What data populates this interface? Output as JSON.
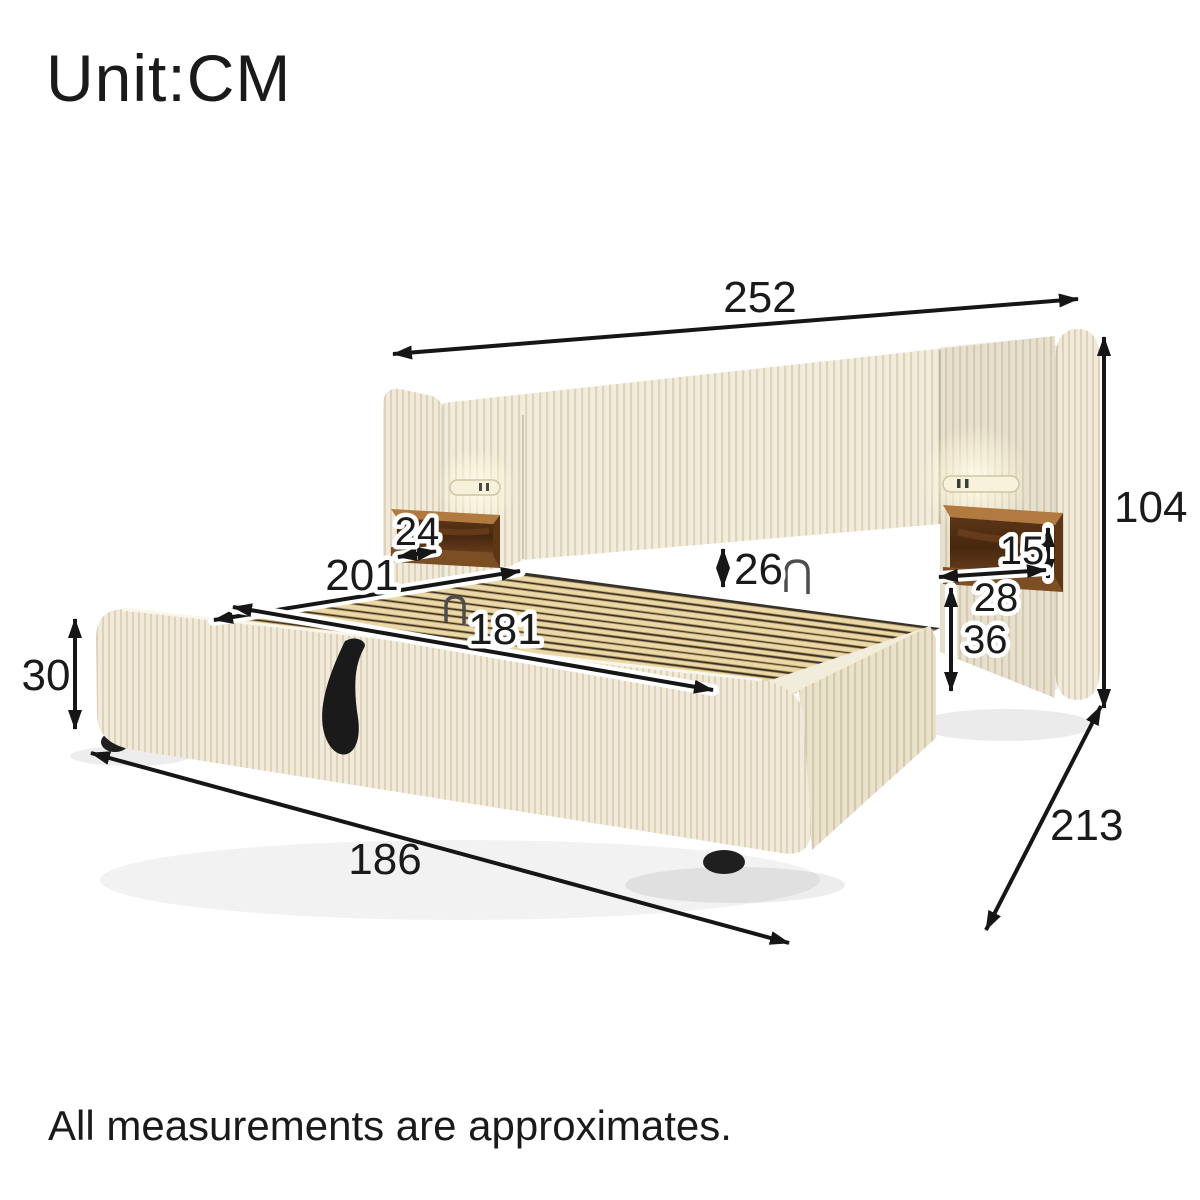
{
  "header": {
    "unit_label": "Unit:CM"
  },
  "footer": {
    "note": "All measurements are approximates."
  },
  "unit": "CM",
  "measurements": {
    "overall_width": "252",
    "headboard_height": "104",
    "slat_length": "201",
    "slat_width": "181",
    "headboard_gap": "26",
    "left_shelf_depth": "24",
    "shelf_height": "15",
    "shelf_width": "28",
    "shelf_to_base": "36",
    "base_height": "30",
    "front_width": "186",
    "overall_depth": "213"
  },
  "colors": {
    "fabric": "#f0e9d8",
    "wood_shelf": "#8a5a2e",
    "slat_wood": "#ead8a8",
    "ink": "#1a1a1a"
  }
}
